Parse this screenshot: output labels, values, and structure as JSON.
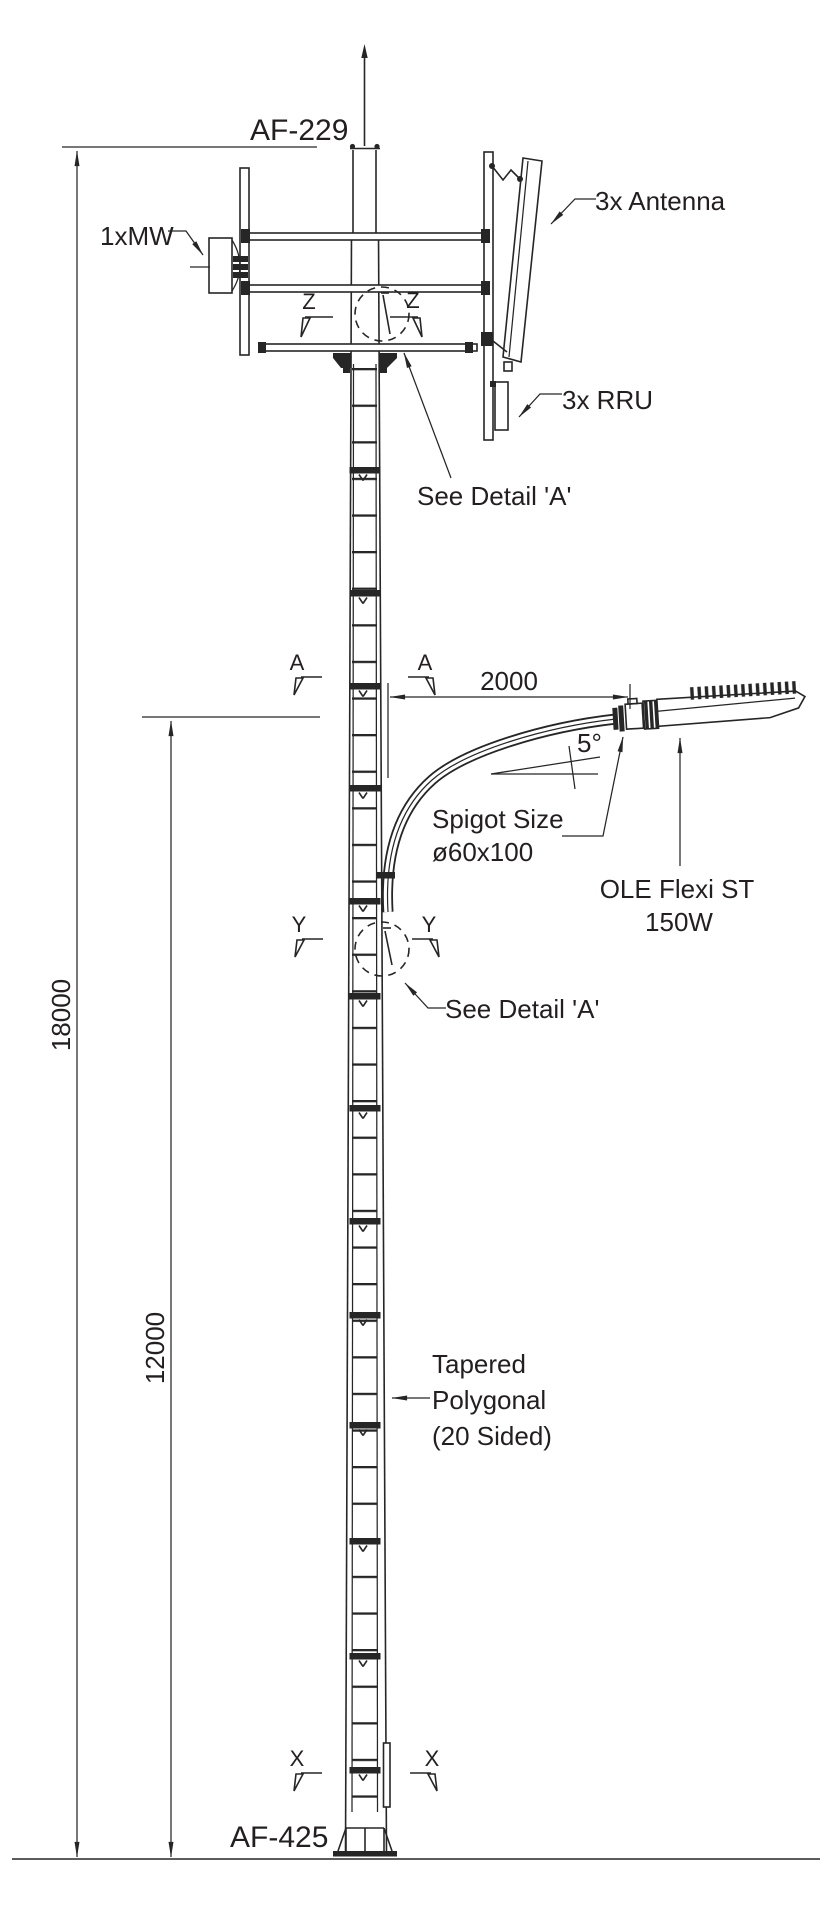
{
  "drawing_title": "Tapered polygonal smart pole elevation",
  "labels": {
    "af229": "AF-229",
    "af425": "AF-425",
    "mw": "1xMW",
    "antenna": "3x Antenna",
    "rru": "3x RRU",
    "see_detail_top": "See Detail 'A'",
    "see_detail_mid": "See Detail 'A'",
    "spigot1": "Spigot Size",
    "spigot2": "ø60x100",
    "ole1": "OLE Flexi ST",
    "ole2": "150W",
    "tapered1": "Tapered",
    "tapered2": "Polygonal",
    "tapered3": "(20 Sided)",
    "angle": "5°"
  },
  "dimensions": {
    "overall_height": "18000",
    "luminaire_height": "12000",
    "arm_length": "2000"
  },
  "sections": {
    "a": "A",
    "y": "Y",
    "z": "Z",
    "x": "X"
  },
  "colors": {
    "line": "#262626",
    "text": "#231f20",
    "background": "#ffffff"
  }
}
